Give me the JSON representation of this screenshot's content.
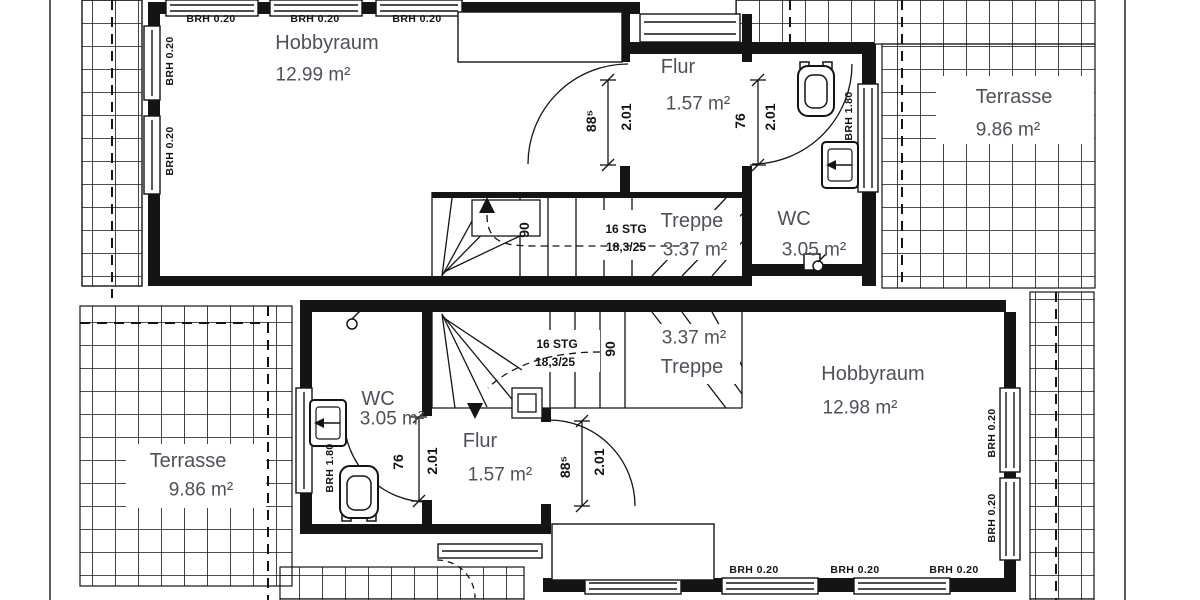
{
  "plan_type": "floor-plan",
  "colors": {
    "background": "#ffffff",
    "line": "#141414",
    "room_text": "#50505c"
  },
  "window_labels": {
    "low": "BRH 0.20",
    "high": "BRH 1.80"
  },
  "stairs": {
    "steps": "16 STG",
    "rise_run": "18,3/25",
    "door_width": "90"
  },
  "doors": {
    "width_small": "76",
    "width_large": "88⁵",
    "height": "2.01"
  },
  "units": {
    "top": {
      "hobbyraum": {
        "name": "Hobbyraum",
        "area": "12.99 m²"
      },
      "flur": {
        "name": "Flur",
        "area": "1.57 m²"
      },
      "wc": {
        "name": "WC",
        "area": "3.05 m²"
      },
      "treppe": {
        "name": "Treppe",
        "area": "3.37 m²"
      },
      "terrasse": {
        "name": "Terrasse",
        "area": "9.86 m²"
      }
    },
    "bottom": {
      "hobbyraum": {
        "name": "Hobbyraum",
        "area": "12.98 m²"
      },
      "flur": {
        "name": "Flur",
        "area": "1.57 m²"
      },
      "wc": {
        "name": "WC",
        "area": "3.05 m²"
      },
      "treppe": {
        "name": "Treppe",
        "area": "3.37 m²"
      },
      "terrasse": {
        "name": "Terrasse",
        "area": "9.86 m²"
      }
    }
  }
}
